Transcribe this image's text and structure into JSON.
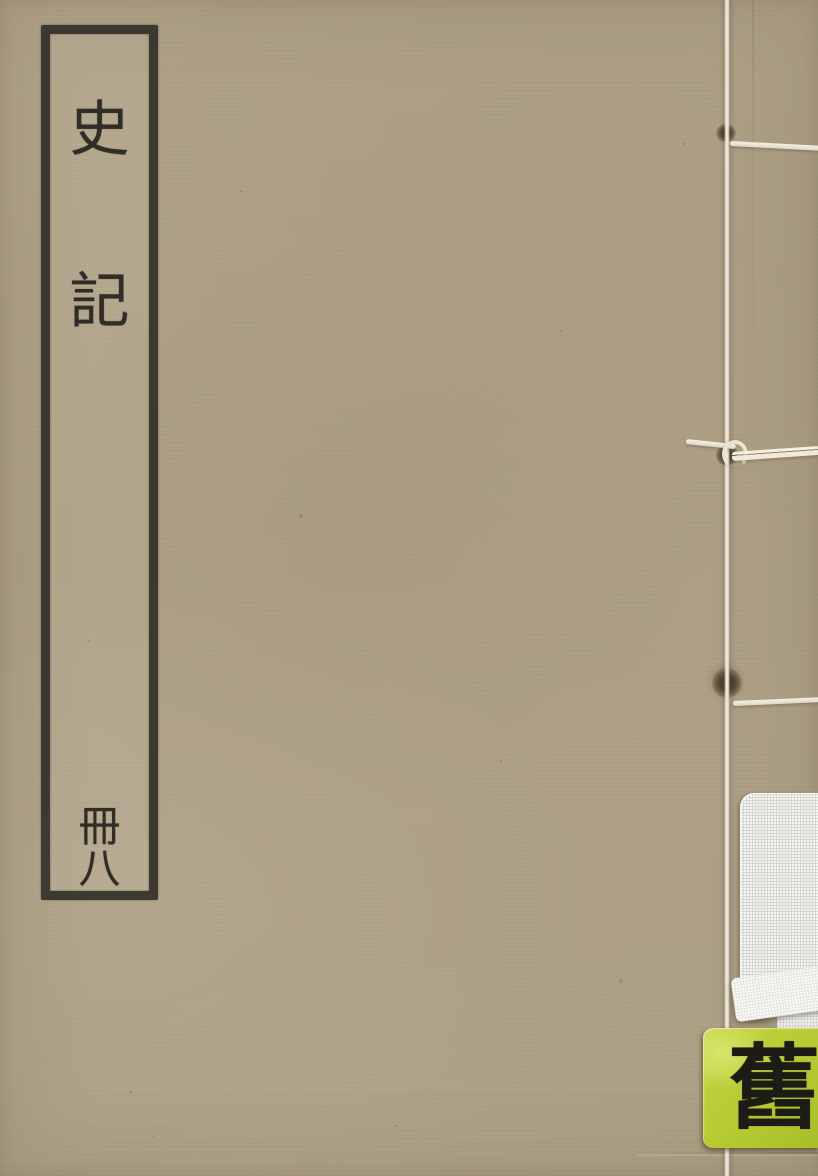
{
  "book_cover": {
    "title_slip": {
      "title": "史記",
      "title_chars": [
        "史",
        "記"
      ],
      "volume": "冊八",
      "volume_chars": [
        "冊",
        "八"
      ]
    },
    "sticker": {
      "char": "舊"
    },
    "colors": {
      "cover_tan": "#ada085",
      "slip_border_ink": "#3c3931",
      "character_ink": "#2f2d26",
      "thread_white": "#ece6d8",
      "library_label_white": "#f4f4f0",
      "sticker_green": "#b7cc35",
      "sticker_ink": "#1c1b15"
    }
  }
}
